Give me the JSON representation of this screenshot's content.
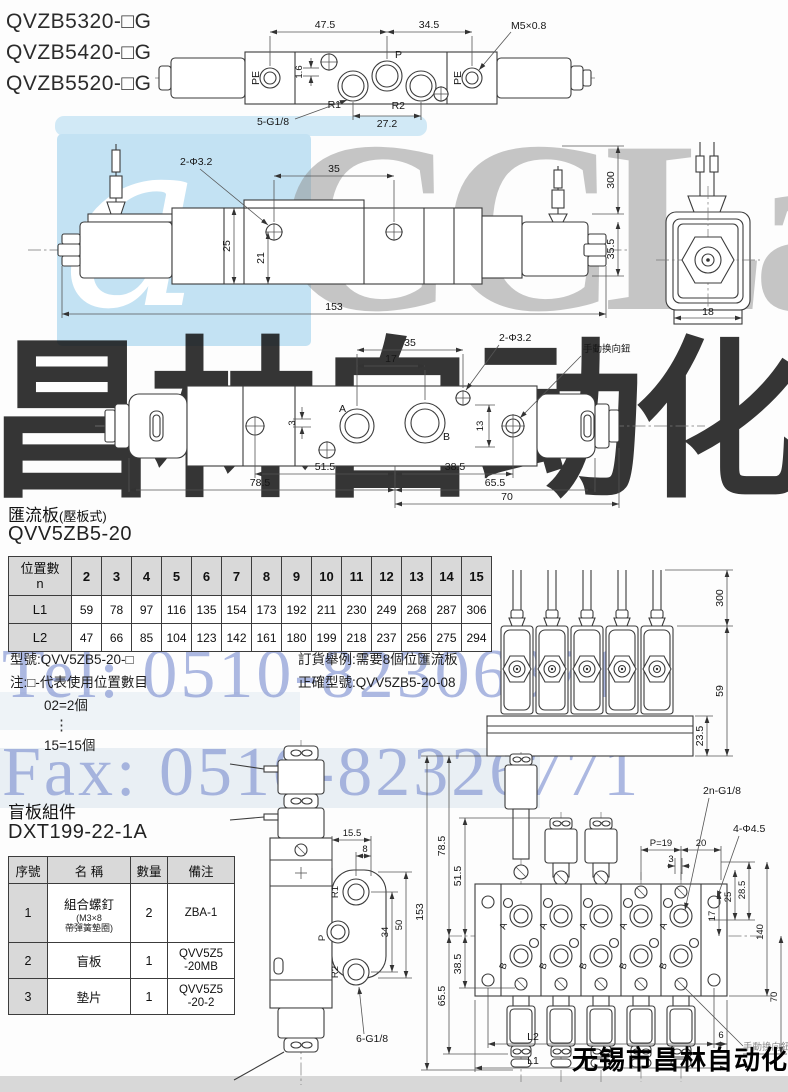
{
  "models": [
    "QVZB5320-□G",
    "QVZB5420-□G",
    "QVZB5520-□G"
  ],
  "watermarks": {
    "logo_glyph": "a",
    "brand": "CCLair",
    "brand_cn": "昌林自动化",
    "tel": "Tel: 0510-82306871",
    "fax": "Fax: 0510-82326771",
    "company": "无锡市昌林自动化科技"
  },
  "d1": {
    "w475": "47.5",
    "w345": "34.5",
    "m5": "M5×0.8",
    "pe": "PE",
    "p": "P",
    "r1": "R1",
    "r2": "R2",
    "h16": "1.6",
    "g": "5-G1/8",
    "w272": "27.2"
  },
  "d2": {
    "phi": "2-Φ3.2",
    "w35": "35",
    "h300": "300",
    "h25": "25",
    "h21": "21",
    "w153": "153",
    "h355": "35.5",
    "w18": "18"
  },
  "d3": {
    "w35": "35",
    "w17": "17",
    "phi": "2-Φ3.2",
    "manual": "手動换向鈕",
    "a": "A",
    "b": "B",
    "h3": "3",
    "h13": "13",
    "w515": "51.5",
    "w385": "38.5",
    "w785": "78.5",
    "w655": "65.5",
    "w70": "70"
  },
  "manifold_section": {
    "title": "匯流板",
    "subtitle": "(壓板式)",
    "model": "QVV5ZB5-20"
  },
  "ltable": {
    "head_top": "位置數",
    "head_sub": "n",
    "cols": [
      "2",
      "3",
      "4",
      "5",
      "6",
      "7",
      "8",
      "9",
      "10",
      "11",
      "12",
      "13",
      "14",
      "15"
    ],
    "l1_label": "L1",
    "l1": [
      "59",
      "78",
      "97",
      "116",
      "135",
      "154",
      "173",
      "192",
      "211",
      "230",
      "249",
      "268",
      "287",
      "306"
    ],
    "l2_label": "L2",
    "l2": [
      "47",
      "66",
      "85",
      "104",
      "123",
      "142",
      "161",
      "180",
      "199",
      "218",
      "237",
      "256",
      "275",
      "294"
    ]
  },
  "notes": {
    "model_line": "型號:QVV5ZB5-20-□",
    "note_line": "注:□-代表使用位置數目",
    "ex1": "02=2個",
    "dots": "⋮",
    "ex2": "15=15個",
    "order1": "訂貨舉例:需要8個位匯流板",
    "order2": "正確型號:QVV5ZB5-20-08"
  },
  "mf": {
    "h300": "300",
    "h59": "59",
    "h235": "23.5"
  },
  "blind_section": {
    "title": "盲板組件",
    "model": "DXT199-22-1A"
  },
  "ptable": {
    "h_no": "序號",
    "h_name": "名 稱",
    "h_qty": "數量",
    "h_note": "備注",
    "rows": [
      {
        "no": "1",
        "name": "組合螺釘",
        "name_sub": "(M3×8\n帶彈簧墊圈)",
        "qty": "2",
        "note": "ZBA-1"
      },
      {
        "no": "2",
        "name": "盲板",
        "name_sub": "",
        "qty": "1",
        "note": "QVV5Z5\n-20MB"
      },
      {
        "no": "3",
        "name": "墊片",
        "name_sub": "",
        "qty": "1",
        "note": "QVV5Z5\n-20-2"
      }
    ]
  },
  "bp": {
    "w155": "15.5",
    "w8": "8",
    "r1": "R1",
    "p": "P",
    "r2": "R2",
    "h34": "34",
    "h50": "50",
    "g": "6-G1/8"
  },
  "mt": {
    "h153": "153",
    "h785": "78.5",
    "h515": "51.5",
    "h655": "65.5",
    "h385": "38.5",
    "g": "2n-G1/8",
    "p19": "P=19",
    "w20": "20",
    "w3": "3",
    "phi": "4-Φ4.5",
    "h25": "25",
    "h285": "28.5",
    "h17": "17",
    "h140": "140",
    "h70": "70",
    "l2": "L2",
    "l1": "L1",
    "w6": "6",
    "manual": "手動换向鈕",
    "a": "A",
    "b": "B"
  }
}
